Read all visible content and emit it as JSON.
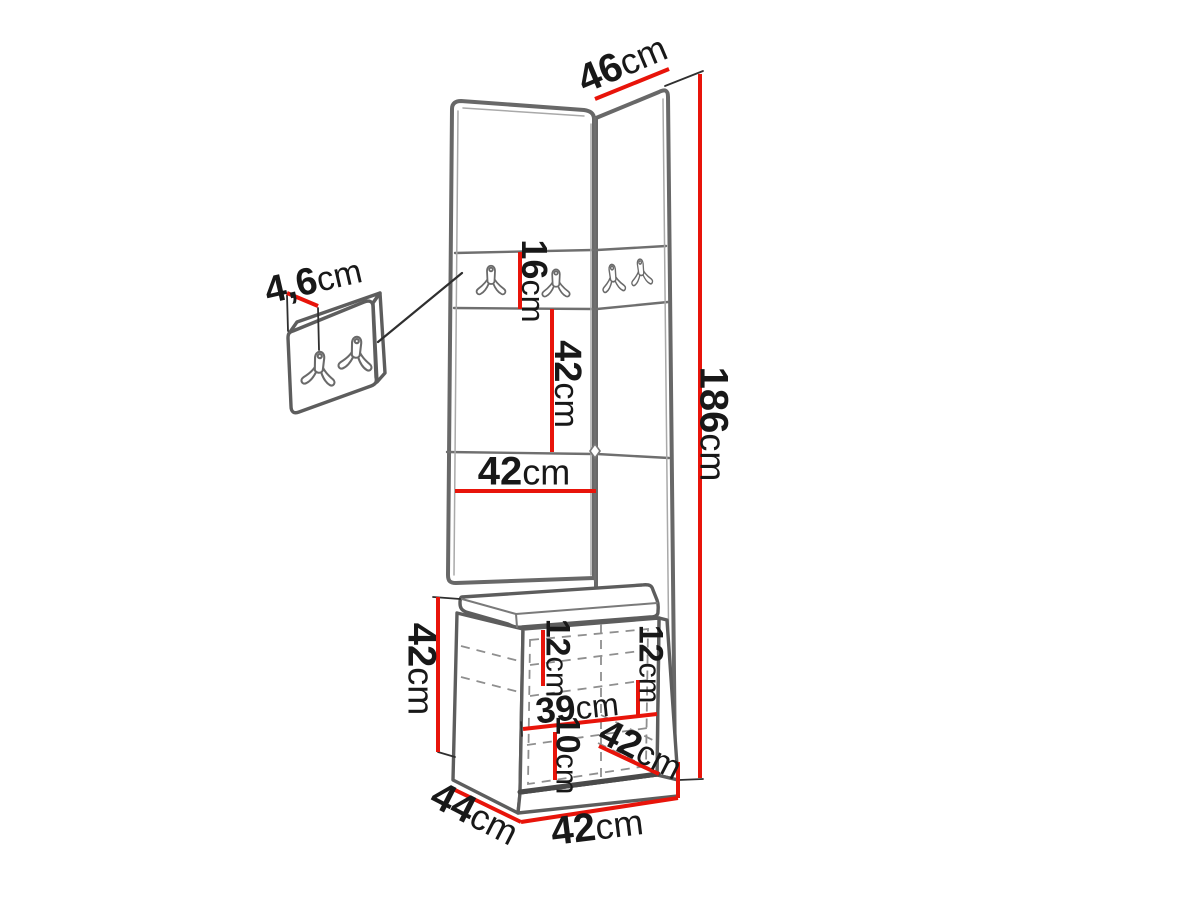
{
  "diagram": {
    "title": "hallway furniture set dimension diagram",
    "background": "#ffffff",
    "colors": {
      "dimension_line": "#e8140a",
      "furniture_outline": "#686868",
      "hidden_line": "#8f8f8f",
      "label_text": "#181818"
    },
    "icons": {
      "hook": "double-coat-hook-icon",
      "button": "diamond-tufting-button-icon"
    },
    "dimensions": {
      "top_depth": {
        "value": "46",
        "unit": "cm"
      },
      "total_height": {
        "value": "186",
        "unit": "cm"
      },
      "hook_panel_height": {
        "value": "16",
        "unit": "cm"
      },
      "mid_panel_height": {
        "value": "42",
        "unit": "cm"
      },
      "panel_width": {
        "value": "42",
        "unit": "cm"
      },
      "small_panel_thickness": {
        "value": "4,6",
        "unit": "cm"
      },
      "bench_height": {
        "value": "42",
        "unit": "cm"
      },
      "inner_top_height": {
        "value": "12",
        "unit": "cm"
      },
      "inner_right_height": {
        "value": "12",
        "unit": "cm"
      },
      "inner_width": {
        "value": "39",
        "unit": "cm"
      },
      "inner_bottom_height": {
        "value": "10",
        "unit": "cm"
      },
      "bench_top_depth": {
        "value": "42",
        "unit": "cm"
      },
      "bench_depth": {
        "value": "44",
        "unit": "cm"
      },
      "bench_width": {
        "value": "42",
        "unit": "cm"
      }
    }
  }
}
